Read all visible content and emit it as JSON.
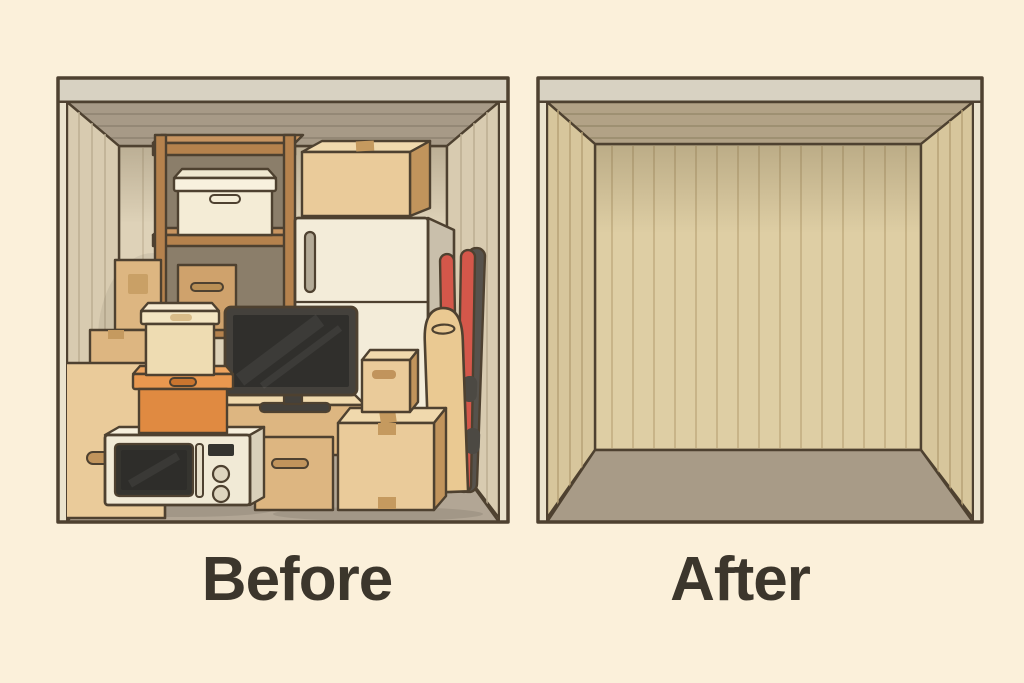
{
  "scene": {
    "type": "before-after-comparison",
    "subject": "self-storage-unit"
  },
  "units": {
    "before": {
      "label": "Before",
      "items": [
        "wooden-shelving-unit",
        "white-storage-box",
        "stacked-cardboard-boxes",
        "lidded-cream-box",
        "orange-storage-box",
        "microwave-oven",
        "flat-screen-tv",
        "tv-console-box",
        "refrigerator",
        "moving-box-on-refrigerator",
        "skis",
        "ironing-board",
        "taped-moving-boxes"
      ]
    },
    "after": {
      "label": "After",
      "items": []
    }
  },
  "colors": {
    "bg": "#fbf0da",
    "outline": "#4e4130",
    "labelText": "#3c362c",
    "lintel": "#d8d2c2",
    "jamb": "#ebe3cd",
    "ceilingBefore": "#a79a87",
    "wallBefore": "#d8cbb0",
    "backWallBefore": "#ded2b8",
    "floorBefore": "#b2a695",
    "ceilingAfter": "#b2a286",
    "wallAfter": "#d7c69c",
    "backWallAfter": "#decea4",
    "floorAfter": "#a89b87",
    "cardboardLight": "#eacb9a",
    "cardboardMid": "#ddb681",
    "cardboardDark": "#cfa26c",
    "cardboardShade": "#c1945c",
    "cardboardTop": "#f0d9ad",
    "tape": "#c59a5f",
    "wood": "#b5824d",
    "woodLight": "#c79460",
    "shelfShadow": "#8b7e6a",
    "whiteBox": "#f4ecd6",
    "whiteBoxLid": "#f8f1de",
    "creamBoxBody": "#eedcb2",
    "creamBoxLid": "#f3e5c2",
    "orangeBox": "#e08a41",
    "orangeLid": "#e9984f",
    "orangeTop": "#eda45f",
    "orangeSlot": "#c9752f",
    "fridgeFront": "#f3ecd9",
    "fridgeSide": "#c9bfab",
    "handleGray": "#b3aa97",
    "applianceWhite": "#f1ead6",
    "applianceSide": "#d9d0ba",
    "applianceDark": "#35342f",
    "screenInner": "#2e2d2a",
    "tvFrame": "#44413c",
    "tvScreen": "#302f2c",
    "skiRed": "#d4574a",
    "skiDark": "#56524c",
    "boardTan": "#eac992"
  }
}
